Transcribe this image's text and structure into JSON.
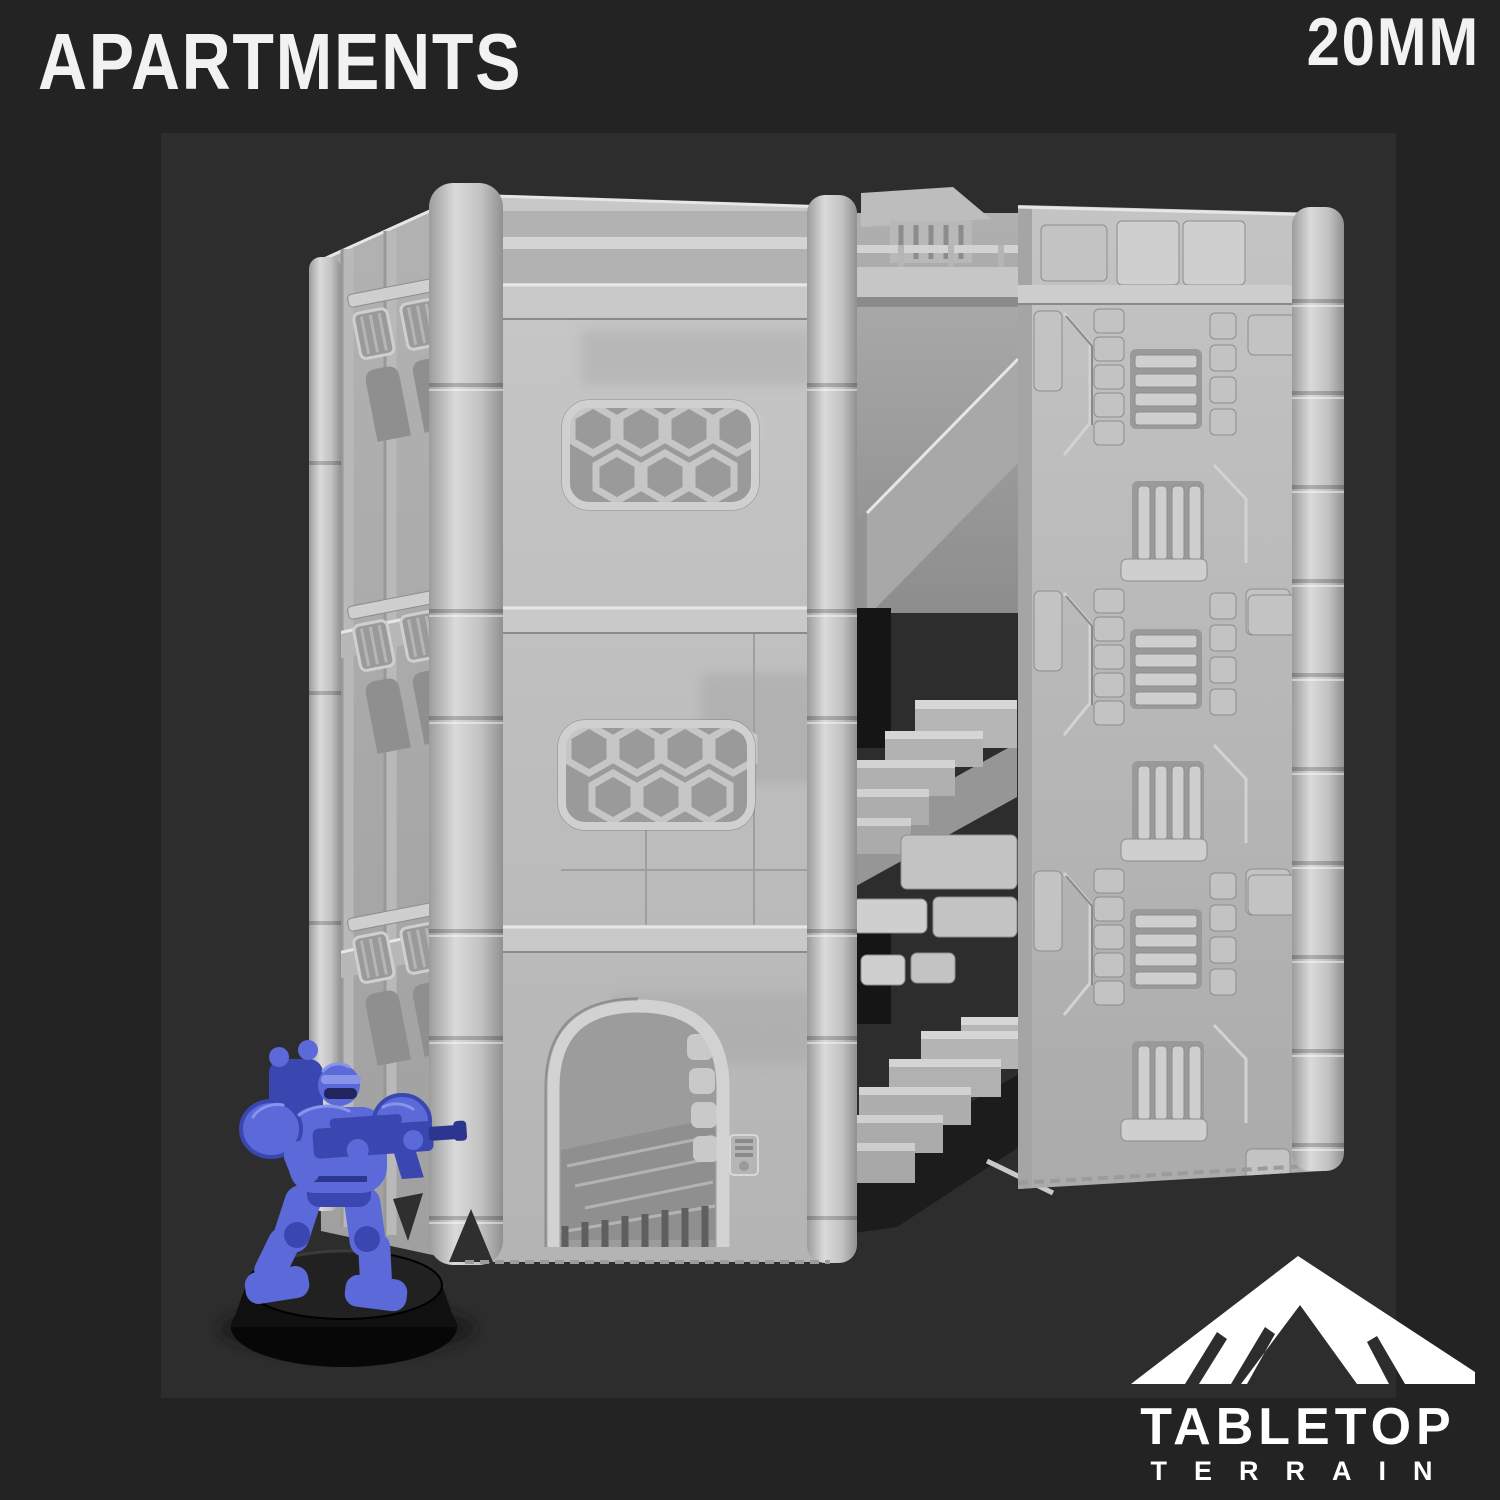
{
  "header": {
    "title": "APARTMENTS",
    "scale_label": "20MM"
  },
  "logo": {
    "icon": "mountain-icon",
    "brand_top": "TABLETOP",
    "brand_bottom": "TERRAIN"
  },
  "scene": {
    "subject": "grey 3D-printed sci-fi apartment building render",
    "parts": [
      "left-tower-with-hex-windows",
      "arched-doorway",
      "central-stairwell",
      "detailed-wall-panel"
    ],
    "miniature": "blue space marine figure on round black base"
  },
  "palette": {
    "outer_bg": "#232323",
    "render_bg": "#2d2d2d",
    "text_white": "#f2f2f2",
    "logo_white": "#ffffff",
    "model_light": "#cdcdcd",
    "model_face": "#bdbdbd",
    "model_side": "#a9a9a9",
    "model_recess": "#9a9a9a",
    "model_shadow": "#7f7f7f",
    "opening_dark": "#151515",
    "mini_blue": "#5b69d9",
    "mini_blue_dark": "#3a47b0",
    "mini_blue_light": "#8794ea",
    "mini_visor": "#20255d",
    "base_black": "#0e0e0e"
  }
}
